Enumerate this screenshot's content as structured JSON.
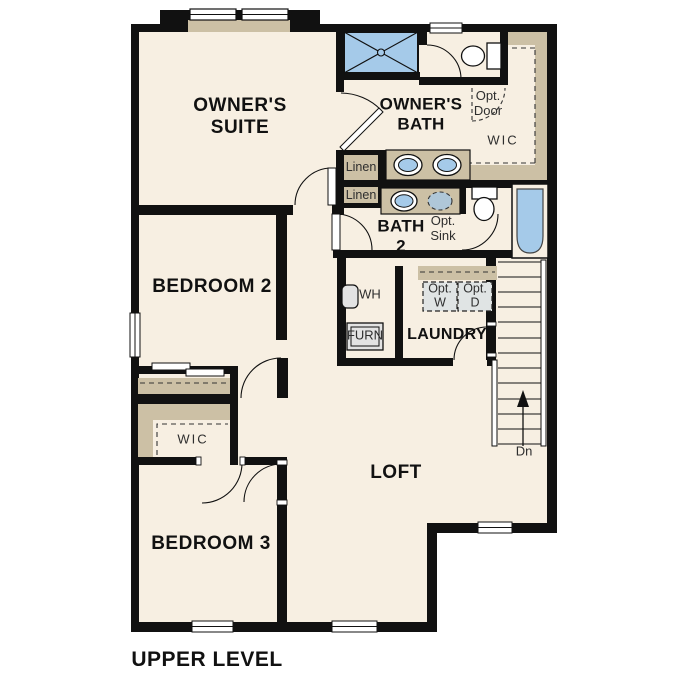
{
  "plan_title": "UPPER LEVEL",
  "colors": {
    "floor": "#f7efe2",
    "wall": "#111111",
    "cabinet_tan": "#ccc0a5",
    "fixture_blue": "#a5cae9",
    "appliance_gray": "#e3e3e3"
  },
  "rooms": {
    "owners_suite": {
      "label": "OWNER'S\nSUITE"
    },
    "owners_bath": {
      "label": "OWNER'S\nBATH"
    },
    "wic_upper": {
      "label": "WIC"
    },
    "bath2": {
      "label": "BATH\n2"
    },
    "bedroom2": {
      "label": "BEDROOM 2"
    },
    "laundry": {
      "label": "LAUNDRY"
    },
    "wic_lower": {
      "label": "WIC"
    },
    "bedroom3": {
      "label": "BEDROOM 3"
    },
    "loft": {
      "label": "LOFT"
    }
  },
  "features": {
    "linen1": "Linen",
    "linen2": "Linen",
    "opt_door": "Opt.\nDoor",
    "opt_sink": "Opt.\nSink",
    "opt_washer": "Opt.\nW",
    "opt_dryer": "Opt.\nD",
    "water_heater": "WH",
    "furnace": "FURN",
    "stairs_down": "Dn"
  }
}
